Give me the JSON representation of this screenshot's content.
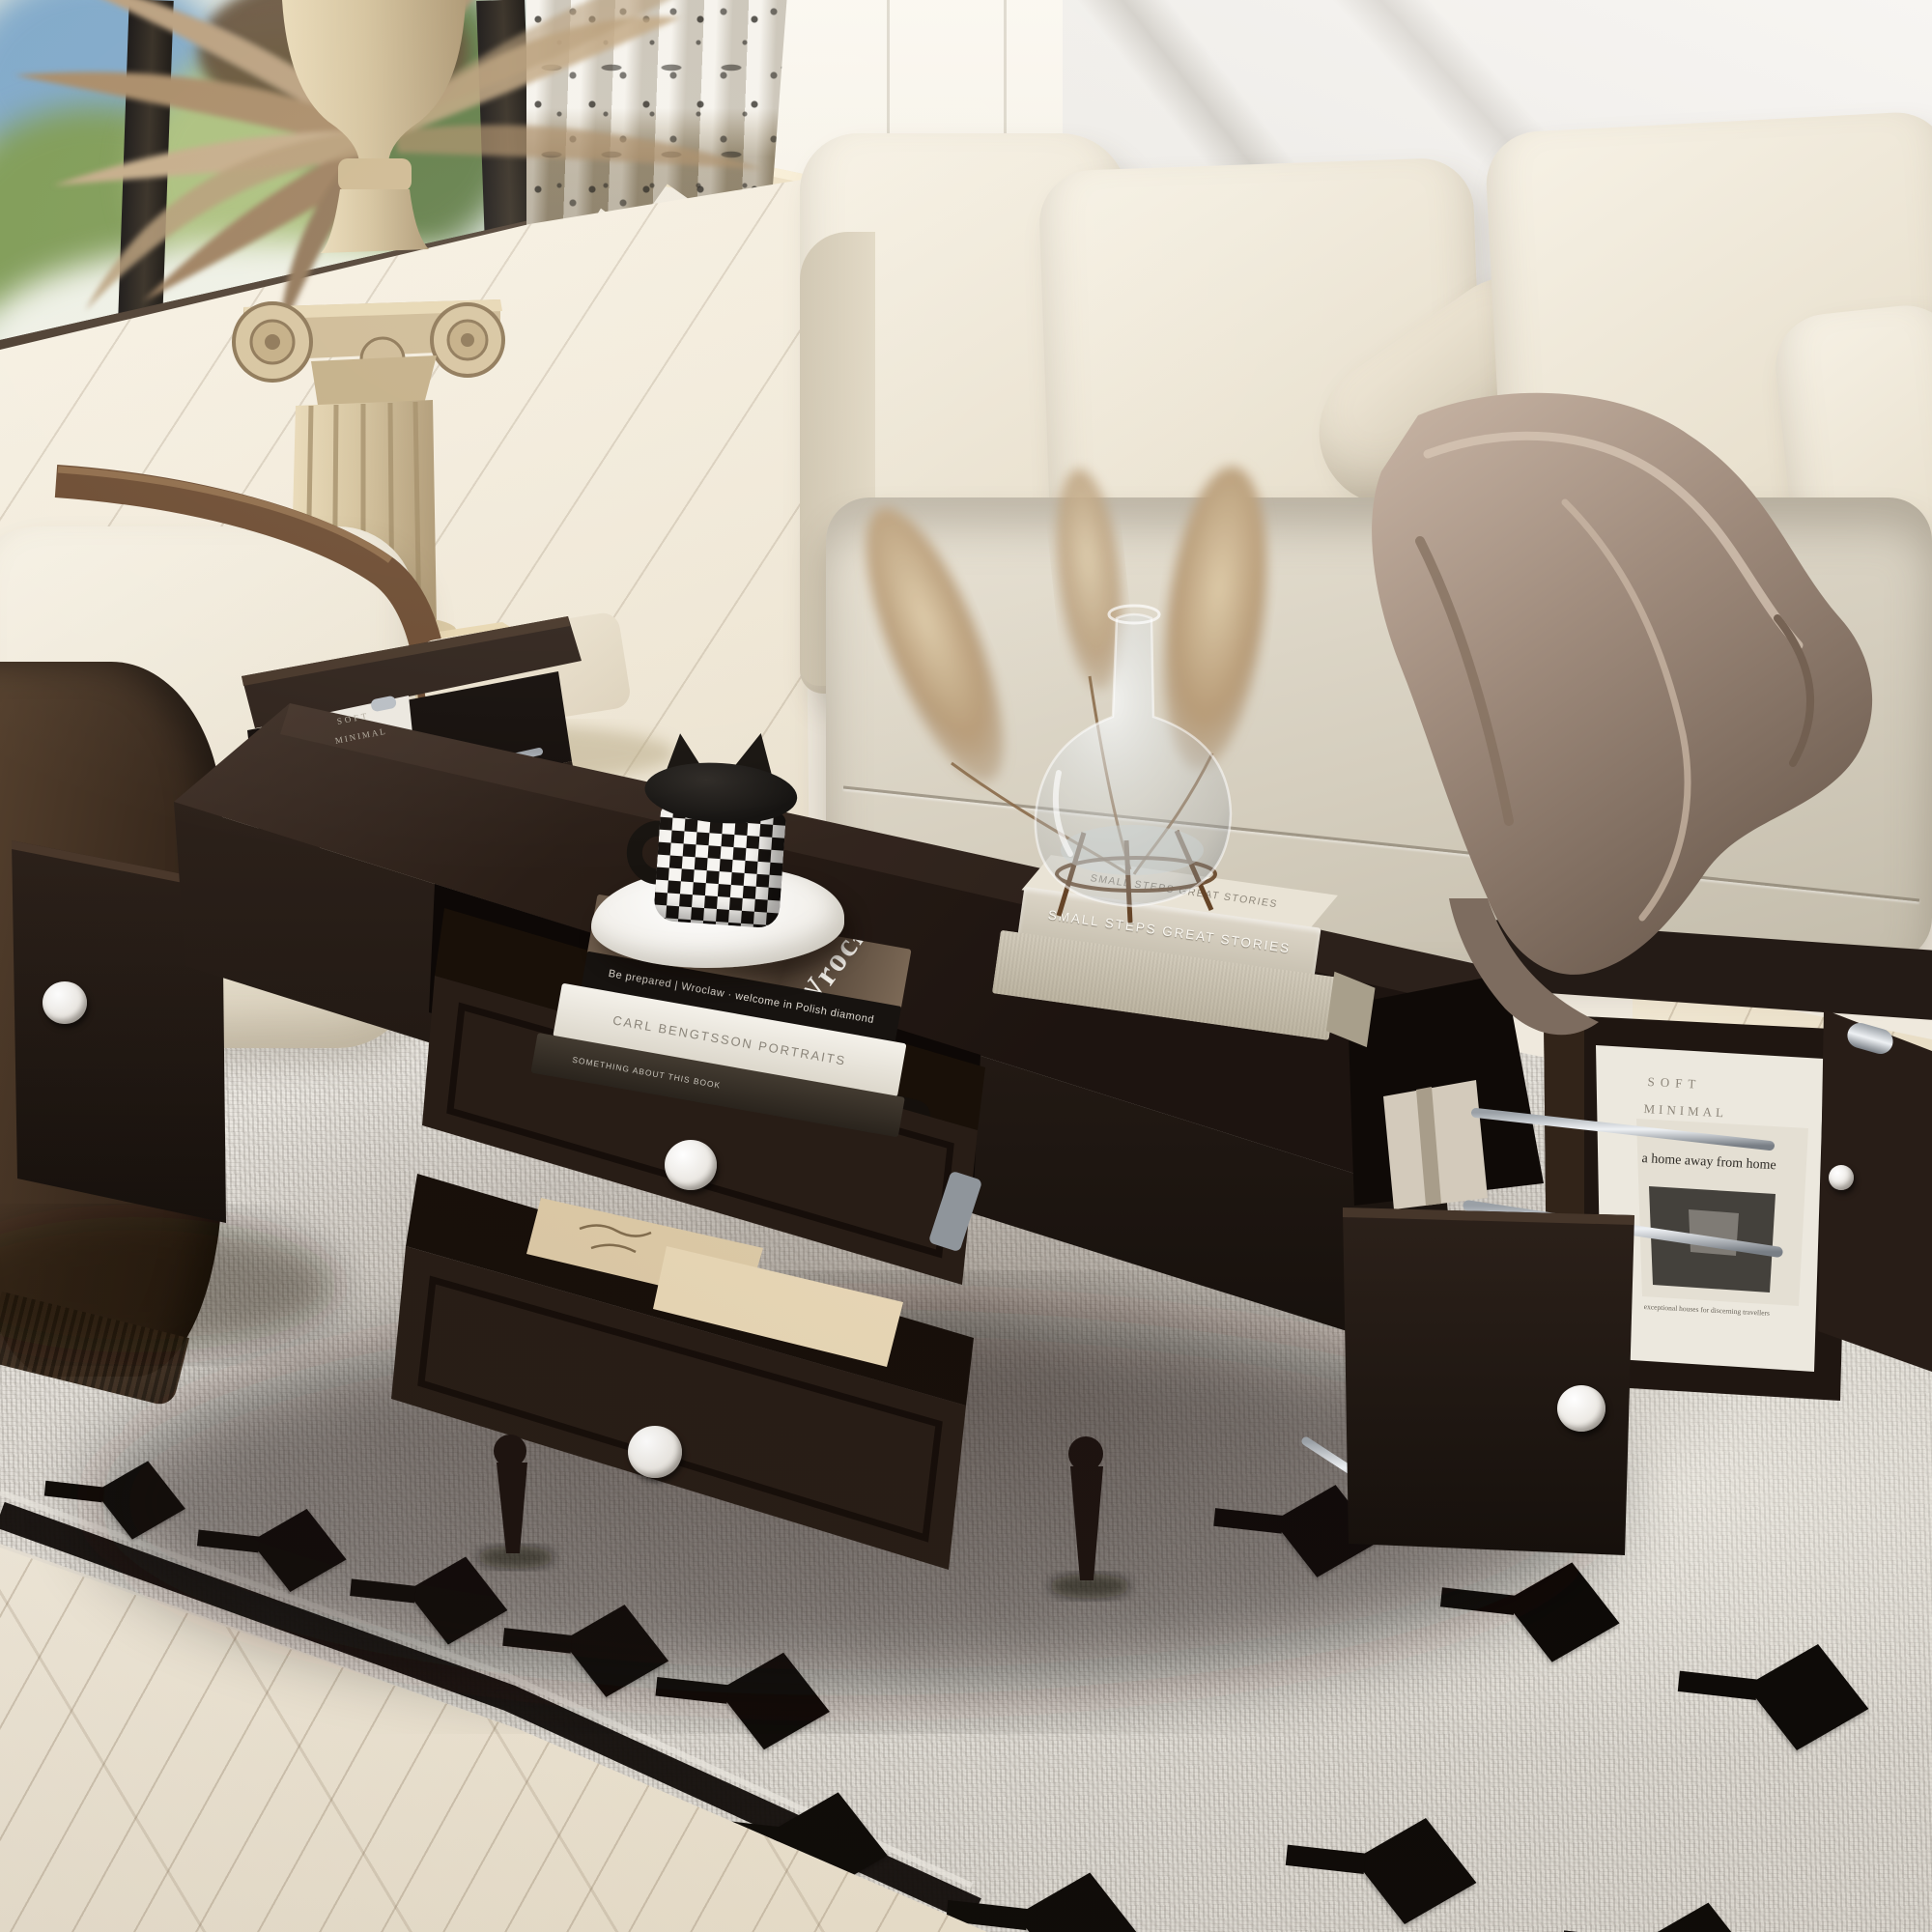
{
  "photo": {
    "subject": "Espresso brown rectangular coffee table with two open front drawers and fold-out magazine-rack end doors, styled in a living room with a cream sofa, boucle armchair, classical column pedestal with dried palms, patterned curtain and black-motif area rug"
  },
  "books": {
    "wroclaw_cover_title": "Wrocław",
    "wroclaw_spine": "Be prepared  |  Wroclaw · welcome in Polish diamond",
    "portraits_spine": "CARL BENGTSSON   PORTRAITS",
    "notes_spine": "SOMETHING ABOUT THIS BOOK",
    "stories_spine": "SMALL STEPS  GREAT STORIES",
    "stories_cover": "SMALL STEPS GREAT STORIES"
  },
  "magazines": {
    "soft_minimal_line1": "SOFT",
    "soft_minimal_line2": "MINIMAL",
    "home_title": "a home away from home",
    "home_subtitle": "exceptional houses for discerning travellers",
    "left_rack_line1": "SOFT",
    "left_rack_line2": "MINIMAL"
  },
  "palette": {
    "table_wood": "#241a15",
    "sofa_fabric": "#ece5d6",
    "seat_fabric": "#d9d2c4",
    "throw_satin": "#9c8a7c",
    "rug_base": "#e8e5df",
    "rug_motif": "#0e0b08",
    "floor_wood": "#f3ecde",
    "curtain_dark": "#93876f",
    "marble_wall": "#f1efec",
    "column_stone": "#d9c9a8",
    "knob_white": "#f4f2ee",
    "rail_chrome": "#c9ced4"
  }
}
